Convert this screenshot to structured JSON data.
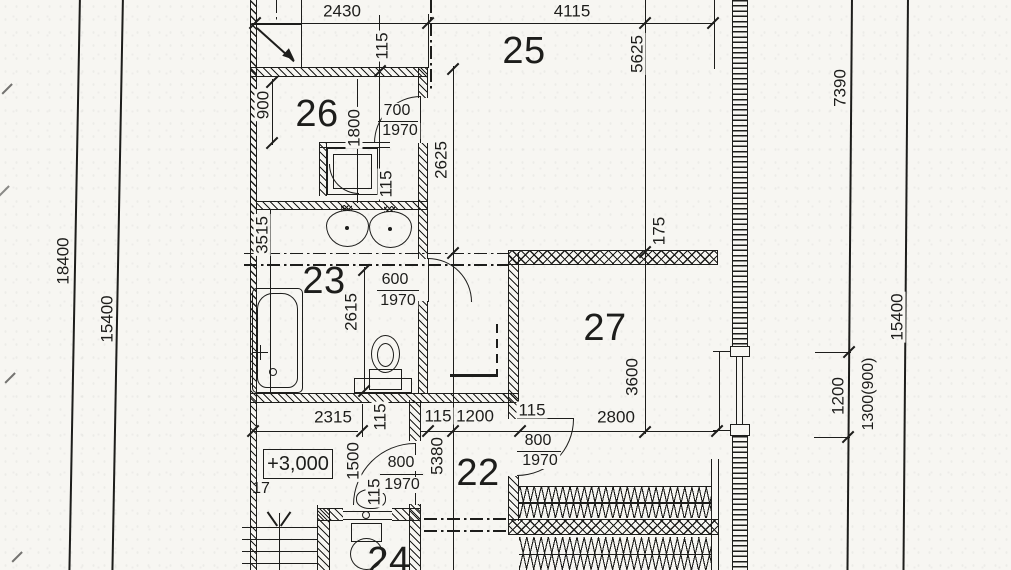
{
  "drawing": {
    "kind": "scanned architectural floor plan, black ink on white paper",
    "colors": {
      "paper": "#f7f6f2",
      "ink": "#1d1d1b"
    }
  },
  "rooms": {
    "r22": "22",
    "r23": "23",
    "r24": "24",
    "r25": "25",
    "r26": "26",
    "r27": "27"
  },
  "dims": {
    "d2430": "2430",
    "d4115": "4115",
    "d115_top": "115",
    "d115_shower": "115",
    "d115_wall": "115",
    "d115_chain": "115",
    "d115_27": "115",
    "d115_hall": "115",
    "d900": "900",
    "d1800": "1800",
    "d2625": "2625",
    "d5625": "5625",
    "d175": "175",
    "d3515": "3515",
    "d2615": "2615",
    "d3600": "3600",
    "d2800": "2800",
    "d2315": "2315",
    "d1200_chain": "1200",
    "d5380": "5380",
    "d1500": "1500",
    "d18400": "18400",
    "d15400_left": "15400",
    "d7390": "7390",
    "d15400_right": "15400",
    "d1200_right": "1200",
    "d1300_900": "1300(900)"
  },
  "doors": {
    "d26": {
      "w": "700",
      "h": "1970"
    },
    "d23": {
      "w": "600",
      "h": "1970"
    },
    "d_hall": {
      "w": "800",
      "h": "1970"
    },
    "d27": {
      "w": "800",
      "h": "1970"
    }
  },
  "ann": {
    "level": "+3,000",
    "stairs": "17"
  }
}
